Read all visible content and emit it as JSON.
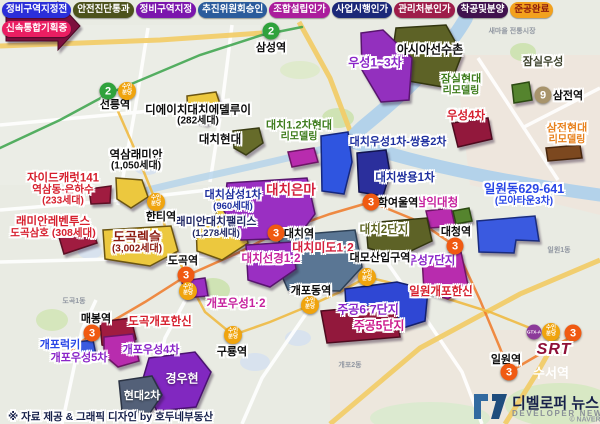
{
  "legend": {
    "rows": [
      [
        {
          "label": "정비구역지정전",
          "bg": "#2b2fd9",
          "fg": "#ffffff"
        },
        {
          "label": "안전진단통과",
          "bg": "#4c521c",
          "fg": "#ffffff"
        },
        {
          "label": "정비구역지정",
          "bg": "#7b16ad",
          "fg": "#ffffff"
        },
        {
          "label": "추진위원회승인",
          "bg": "#2b5c9c",
          "fg": "#ffffff"
        },
        {
          "label": "조합설립인가",
          "bg": "#ab1d9c",
          "fg": "#ffffff"
        },
        {
          "label": "사업시행인가",
          "bg": "#1b2878",
          "fg": "#ffffff"
        },
        {
          "label": "관리처분인가",
          "bg": "#9e1d4a",
          "fg": "#ffffff"
        },
        {
          "label": "착공및분양",
          "bg": "#40124e",
          "fg": "#ffffff"
        },
        {
          "label": "준공완료",
          "bg": "#f2a11e",
          "fg": "#8c1a0e"
        }
      ],
      [
        {
          "label": "신속통합기획중",
          "bg": "#ea1e62",
          "fg": "#ffffff"
        }
      ]
    ]
  },
  "srt": {
    "srt_label": "SRT",
    "station_label": "수서역",
    "badges": [
      {
        "type": "gtxa",
        "label": "GTX-A",
        "x": 534,
        "y": 332
      },
      {
        "type": "suin",
        "label": "수인분당",
        "label_lines": [
          "수인",
          "분당"
        ],
        "x": 551,
        "y": 332
      },
      {
        "type": "line3",
        "label": "3",
        "x": 573,
        "y": 333
      }
    ]
  },
  "footer": {
    "credit": "※ 자료 제공 & 그래픽 디자인 by 호두네부동산"
  },
  "logo": {
    "title": "디벨로퍼 뉴스",
    "subtitle": "DEVELOPER NEWS"
  },
  "map": {
    "area_labels": [
      {
        "text": "새마을 전통시장",
        "x": 512,
        "y": 31
      },
      {
        "text": "도곡1동",
        "x": 74,
        "y": 301
      },
      {
        "text": "개포2동",
        "x": 350,
        "y": 365
      },
      {
        "text": "일원1동",
        "x": 559,
        "y": 250
      },
      {
        "text": "© NAVER",
        "x": 585,
        "y": 420
      }
    ],
    "stations": [
      {
        "name": "삼성역",
        "x": 271,
        "y": 47,
        "badges": [
          {
            "type": "line2",
            "label": "2",
            "x": 271,
            "y": 31
          }
        ]
      },
      {
        "name": "선릉역",
        "x": 115,
        "y": 104,
        "badges": [
          {
            "type": "line2",
            "label": "2",
            "x": 108,
            "y": 91
          },
          {
            "type": "suin",
            "label": "수인분당",
            "label_lines": [
              "수인",
              "분당"
            ],
            "x": 127,
            "y": 91
          }
        ]
      },
      {
        "name": "한티역",
        "x": 161,
        "y": 216,
        "badges": [
          {
            "type": "suin",
            "label": "수인분당",
            "label_lines": [
              "수인",
              "분당"
            ],
            "x": 156,
            "y": 202
          }
        ]
      },
      {
        "name": "도곡역",
        "x": 183,
        "y": 260,
        "badges": [
          {
            "type": "line3",
            "label": "3",
            "x": 186,
            "y": 275
          },
          {
            "type": "suin",
            "label": "수인분당",
            "label_lines": [
              "수인",
              "분당"
            ],
            "x": 188,
            "y": 291
          }
        ]
      },
      {
        "name": "매봉역",
        "x": 96,
        "y": 318,
        "badges": [
          {
            "type": "line3",
            "label": "3",
            "x": 92,
            "y": 333
          }
        ]
      },
      {
        "name": "대치역",
        "x": 299,
        "y": 233,
        "badges": [
          {
            "type": "line3",
            "label": "3",
            "x": 276,
            "y": 233
          }
        ]
      },
      {
        "name": "학여울역",
        "x": 398,
        "y": 202,
        "badges": [
          {
            "type": "line3",
            "label": "3",
            "x": 371,
            "y": 202
          }
        ]
      },
      {
        "name": "대청역",
        "x": 456,
        "y": 231,
        "badges": [
          {
            "type": "line3",
            "label": "3",
            "x": 455,
            "y": 246
          }
        ]
      },
      {
        "name": "대모산입구역",
        "x": 380,
        "y": 257,
        "badges": [
          {
            "type": "suin",
            "label": "수인분당",
            "label_lines": [
              "수인",
              "분당"
            ],
            "x": 367,
            "y": 277
          }
        ]
      },
      {
        "name": "개포동역",
        "x": 311,
        "y": 290,
        "badges": [
          {
            "type": "suin",
            "label": "수인분당",
            "label_lines": [
              "수인",
              "분당"
            ],
            "x": 310,
            "y": 305
          }
        ]
      },
      {
        "name": "구룡역",
        "x": 232,
        "y": 351,
        "badges": [
          {
            "type": "suin",
            "label": "수인분당",
            "label_lines": [
              "수인",
              "분당"
            ],
            "x": 233,
            "y": 335
          }
        ]
      },
      {
        "name": "삼전역",
        "x": 568,
        "y": 95,
        "badges": [
          {
            "type": "line9",
            "label": "9",
            "x": 543,
            "y": 95
          }
        ]
      },
      {
        "name": "일원역",
        "x": 506,
        "y": 359,
        "badges": [
          {
            "type": "line3",
            "label": "3",
            "x": 509,
            "y": 372
          }
        ]
      }
    ],
    "complexes": [
      {
        "x": 198,
        "y": 116,
        "color": "#0d0d0d",
        "lines": [
          {
            "text": "디에이치대치에델루이",
            "size": 11.5
          },
          {
            "text": "(282세대)",
            "size": 10
          }
        ]
      },
      {
        "x": 136,
        "y": 161,
        "color": "#0d0d0d",
        "lines": [
          {
            "text": "역삼래미안",
            "size": 11.5
          },
          {
            "text": "(1,050세대)",
            "size": 10
          }
        ]
      },
      {
        "x": 63,
        "y": 190,
        "color": "#d6202e",
        "lines": [
          {
            "text": "자이드캐럿141",
            "size": 11.5
          },
          {
            "text": "역삼동-은하수",
            "size": 10.5
          },
          {
            "text": "(233세대)",
            "size": 10
          }
        ]
      },
      {
        "x": 53,
        "y": 228,
        "color": "#d6202e",
        "lines": [
          {
            "text": "래미안레벤투스",
            "size": 11.5
          },
          {
            "text": "도곡삼호 (308세대)",
            "size": 10.5
          }
        ]
      },
      {
        "x": 137,
        "y": 243,
        "color": "#8c1a0e",
        "lines": [
          {
            "text": "도곡렉슬",
            "size": 13
          },
          {
            "text": "(3,002세대)",
            "size": 10
          }
        ]
      },
      {
        "x": 233,
        "y": 201,
        "color": "#1e2f9e",
        "lines": [
          {
            "text": "대치삼성1차",
            "size": 11
          },
          {
            "text": "(960세대)",
            "size": 9.5
          }
        ]
      },
      {
        "x": 216,
        "y": 228,
        "color": "#232a66",
        "lines": [
          {
            "text": "래미안대치팰리스",
            "size": 11
          },
          {
            "text": "(1,278세대)",
            "size": 9.5
          }
        ]
      },
      {
        "x": 220,
        "y": 140,
        "color": "#0d0d0d",
        "lines": [
          {
            "text": "대치현대",
            "size": 11.5
          }
        ]
      },
      {
        "x": 299,
        "y": 132,
        "color": "#3f7d1e",
        "lines": [
          {
            "text": "대치1,2차현대",
            "size": 11
          },
          {
            "text": "리모델링",
            "size": 10
          }
        ]
      },
      {
        "x": 291,
        "y": 191,
        "color": "#d41f3c",
        "lines": [
          {
            "text": "대치은마",
            "size": 13.5
          }
        ]
      },
      {
        "x": 398,
        "y": 143,
        "color": "#1e2f9e",
        "lines": [
          {
            "text": "대치우성1차-쌍용2차",
            "size": 11
          }
        ]
      },
      {
        "x": 405,
        "y": 178,
        "color": "#1e2f9e",
        "lines": [
          {
            "text": "대치쌍용1차",
            "size": 11.5
          }
        ]
      },
      {
        "x": 437,
        "y": 203,
        "color": "#c6219e",
        "lines": [
          {
            "text": "삼익대청",
            "size": 11.5
          }
        ]
      },
      {
        "x": 384,
        "y": 230,
        "color": "#5d6420",
        "lines": [
          {
            "text": "대치2단지",
            "size": 11.5
          }
        ]
      },
      {
        "x": 524,
        "y": 195,
        "color": "#2946e6",
        "lines": [
          {
            "text": "일원동629-641",
            "size": 12.5
          },
          {
            "text": "(모아타운3차)",
            "size": 10
          }
        ]
      },
      {
        "x": 430,
        "y": 50,
        "color": "#0d0d0d",
        "lines": [
          {
            "text": "아시아선수촌",
            "size": 12
          }
        ]
      },
      {
        "x": 375,
        "y": 63,
        "color": "#8a25c8",
        "lines": [
          {
            "text": "우성1~3차",
            "size": 12
          }
        ]
      },
      {
        "x": 543,
        "y": 63,
        "color": "#3d422c",
        "lines": [
          {
            "text": "잠실우성",
            "size": 11
          }
        ]
      },
      {
        "x": 461,
        "y": 86,
        "color": "#3f7d1e",
        "lines": [
          {
            "text": "잠실현대",
            "size": 11
          },
          {
            "text": "리모델링",
            "size": 10
          }
        ]
      },
      {
        "x": 466,
        "y": 116,
        "color": "#d6202e",
        "lines": [
          {
            "text": "우성4차",
            "size": 11.5
          }
        ]
      },
      {
        "x": 567,
        "y": 135,
        "color": "#e8821e",
        "lines": [
          {
            "text": "삼전현대",
            "size": 11
          },
          {
            "text": "리모델링",
            "size": 10
          }
        ]
      },
      {
        "x": 323,
        "y": 248,
        "color": "#d41f3c",
        "lines": [
          {
            "text": "대치미도1·2",
            "size": 12
          }
        ]
      },
      {
        "x": 271,
        "y": 259,
        "color": "#c6219e",
        "lines": [
          {
            "text": "대치선경1·2",
            "size": 11.5
          }
        ]
      },
      {
        "x": 236,
        "y": 304,
        "color": "#c6219e",
        "lines": [
          {
            "text": "개포우성1·2",
            "size": 11.5
          }
        ]
      },
      {
        "x": 368,
        "y": 310,
        "color": "#8a25c8",
        "lines": [
          {
            "text": "주공6·7단지",
            "size": 12
          }
        ]
      },
      {
        "x": 379,
        "y": 326,
        "color": "#cc1c8c",
        "lines": [
          {
            "text": "주공5단지",
            "size": 12
          }
        ]
      },
      {
        "x": 431,
        "y": 261,
        "color": "#8a25c8",
        "lines": [
          {
            "text": "우성7단지",
            "size": 11.5
          }
        ]
      },
      {
        "x": 441,
        "y": 292,
        "color": "#d6202e",
        "lines": [
          {
            "text": "일원개포한신",
            "size": 11.5
          }
        ]
      },
      {
        "x": 160,
        "y": 322,
        "color": "#d6202e",
        "lines": [
          {
            "text": "도곡개포한신",
            "size": 11.5
          }
        ]
      },
      {
        "x": 60,
        "y": 346,
        "color": "#2946e6",
        "lines": [
          {
            "text": "개포럭키",
            "size": 11
          }
        ]
      },
      {
        "x": 79,
        "y": 359,
        "color": "#8a25c8",
        "lines": [
          {
            "text": "개포우성5차",
            "size": 11
          }
        ]
      },
      {
        "x": 151,
        "y": 351,
        "color": "#8a25c8",
        "lines": [
          {
            "text": "개포우성4차",
            "size": 11
          }
        ]
      },
      {
        "x": 182,
        "y": 379,
        "color": "#ffffff",
        "plain": true,
        "lines": [
          {
            "text": "경우현",
            "size": 12
          }
        ]
      },
      {
        "x": 142,
        "y": 397,
        "color": "#ffffff",
        "plain": true,
        "lines": [
          {
            "text": "현대2차",
            "size": 11
          }
        ]
      }
    ],
    "polygons": [
      {
        "points": "187,96 216,92 222,110 206,124 188,118",
        "fill": "#ecc83e",
        "stroke": "#6b5512"
      },
      {
        "points": "116,178 142,180 148,197 131,208 117,199",
        "fill": "#ecc83e",
        "stroke": "#6b5512"
      },
      {
        "points": "89,189 111,186 110,203 91,204",
        "fill": "#a01c40",
        "stroke": "#5c0f24"
      },
      {
        "points": "59,237 92,229 97,243 64,254",
        "fill": "#a01c40",
        "stroke": "#5c0f24"
      },
      {
        "points": "103,230 171,226 178,251 150,266 105,259",
        "fill": "#ecc83e",
        "stroke": "#6b5512"
      },
      {
        "points": "196,224 241,219 248,243 222,260 197,251",
        "fill": "#ecc83e",
        "stroke": "#6b5512"
      },
      {
        "points": "213,193 249,190 254,211 217,218",
        "fill": "#ecc83e",
        "stroke": "#6b5512"
      },
      {
        "points": "233,131 259,128 263,143 246,155 234,148",
        "fill": "#666b2a",
        "stroke": "#3a3d14"
      },
      {
        "points": "396,28 446,25 462,54 449,88 408,81 392,56",
        "fill": "#5d6226",
        "stroke": "#33360f"
      },
      {
        "points": "361,33 383,30 412,58 409,100 381,102 362,70",
        "fill": "#9330be",
        "stroke": "#58156e"
      },
      {
        "points": "288,152 314,148 318,162 292,167",
        "fill": "#b82cae",
        "stroke": "#6e1566"
      },
      {
        "points": "227,183 307,178 315,214 297,238 241,240 224,211",
        "fill": "#9a2fc2",
        "stroke": "#58156e"
      },
      {
        "points": "321,136 348,132 352,162 344,194 322,191",
        "fill": "#2f55e0",
        "stroke": "#15277e"
      },
      {
        "points": "357,153 386,150 390,173 383,196 359,192",
        "fill": "#2b2f9c",
        "stroke": "#12144e"
      },
      {
        "points": "512,85 529,82 532,100 514,103",
        "fill": "#55842e",
        "stroke": "#2c4a12"
      },
      {
        "points": "452,123 488,118 492,139 458,147",
        "fill": "#92183c",
        "stroke": "#4e0a1e"
      },
      {
        "points": "546,148 580,145 582,158 548,161",
        "fill": "#7c481f",
        "stroke": "#46250c"
      },
      {
        "points": "426,211 451,208 455,226 430,228",
        "fill": "#b82cae",
        "stroke": "#6e1566"
      },
      {
        "points": "453,211 469,208 472,221 456,224",
        "fill": "#55842e",
        "stroke": "#2c4a12"
      },
      {
        "points": "366,223 427,218 432,241 398,257 368,248",
        "fill": "#5d6226",
        "stroke": "#33360f"
      },
      {
        "points": "280,236 355,230 362,267 340,291 288,290 276,262",
        "fill": "#5a7694",
        "stroke": "#2e4156"
      },
      {
        "points": "246,245 292,242 296,269 270,287 248,280",
        "fill": "#9a2fc2",
        "stroke": "#58156e"
      },
      {
        "points": "182,281 205,278 208,296 184,298",
        "fill": "#9a2fc2",
        "stroke": "#58156e"
      },
      {
        "points": "477,221 535,216 539,241 516,240 514,253 479,252",
        "fill": "#3a5ae0",
        "stroke": "#1a2c7e"
      },
      {
        "points": "345,289 397,282 428,290 425,321 381,335 347,326",
        "fill": "#2f47d4",
        "stroke": "#131f6e"
      },
      {
        "points": "321,311 395,304 400,337 327,343",
        "fill": "#92183c",
        "stroke": "#4e0a1e"
      },
      {
        "points": "422,257 461,252 468,285 448,299 424,291",
        "fill": "#b82cae",
        "stroke": "#6e1566"
      },
      {
        "points": "100,322 131,318 136,339 119,351 102,345",
        "fill": "#a01c40",
        "stroke": "#5c0f24"
      },
      {
        "points": "104,337 133,334 139,361 118,367 104,355",
        "fill": "#b82cae",
        "stroke": "#6e1566"
      },
      {
        "points": "78,342 93,340 96,355 80,357",
        "fill": "#3a5ae0",
        "stroke": "#1a2c7e"
      },
      {
        "points": "149,358 195,352 211,372 196,407 157,411 142,382",
        "fill": "#8128c0",
        "stroke": "#4a1270"
      },
      {
        "points": "119,381 152,376 162,395 150,413 122,411",
        "fill": "#536078",
        "stroke": "#2b3344"
      }
    ]
  }
}
